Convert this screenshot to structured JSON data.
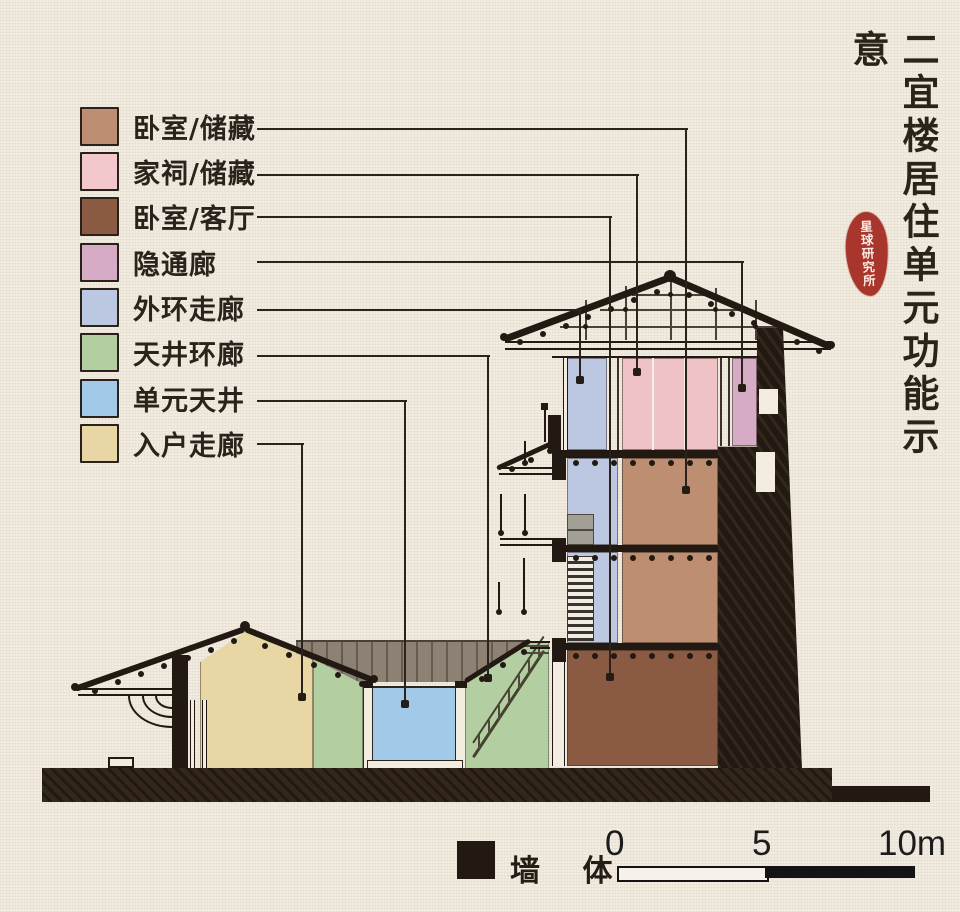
{
  "title": {
    "text": "二宜楼居住单元功能示意"
  },
  "seal": {
    "text": "星球研究所",
    "color": "#a8362c"
  },
  "legend": {
    "items": [
      {
        "label": "卧室/储藏",
        "color": "#bd8e72"
      },
      {
        "label": "家祠/储藏",
        "color": "#f2c8cd"
      },
      {
        "label": "卧室/客厅",
        "color": "#8b5a42"
      },
      {
        "label": "隐通廊",
        "color": "#d6abc6"
      },
      {
        "label": "外环走廊",
        "color": "#bcc8e2"
      },
      {
        "label": "天井环廊",
        "color": "#b3cfa2"
      },
      {
        "label": "单元天井",
        "color": "#a3c9e8"
      },
      {
        "label": "入户走廊",
        "color": "#e8d7a4"
      }
    ]
  },
  "wall_key": {
    "label": "墙 体",
    "color": "#221a12"
  },
  "scale_bar": {
    "tick_0": "0",
    "tick_5": "5",
    "tick_10": "10m"
  },
  "palette": {
    "paper": "#f1ebe0",
    "ink": "#221a12",
    "courtyard_roof_plane": "#8d8174",
    "tower_pink_room": "#efc3c6",
    "tower_tan_room": "#bd8e72",
    "tower_brown_room": "#8b5a42",
    "tower_corridor_blue": "#bcc8e2",
    "courtyard_blue": "#a3c9e8",
    "ring_corridor_green": "#b3cfa2",
    "entry_corridor_cream": "#e8d7a4",
    "hidden_corridor_mauve": "#d6abc6"
  }
}
